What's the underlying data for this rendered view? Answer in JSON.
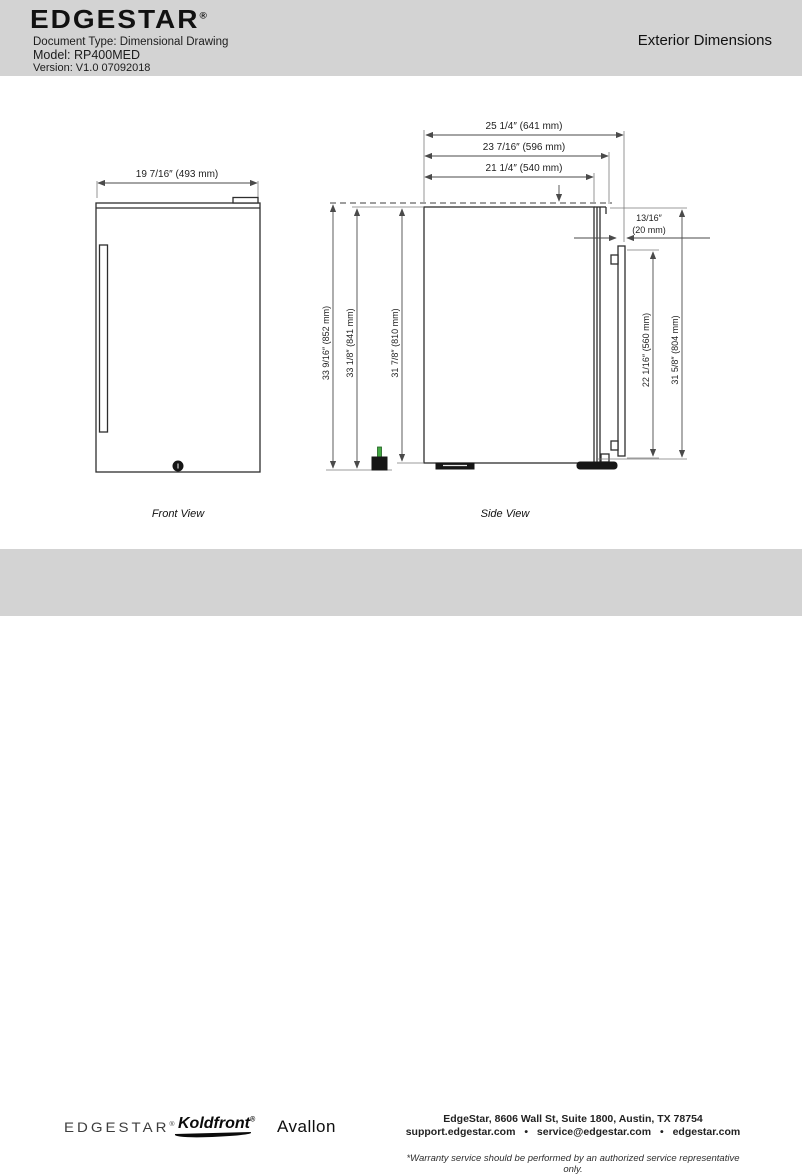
{
  "header": {
    "brand": "EDGESTAR",
    "registered": "®",
    "doc_type": "Document Type: Dimensional Drawing",
    "model": "Model: RP400MED",
    "version": "Version: V1.0 07092018",
    "page_title": "Exterior Dimensions"
  },
  "drawing": {
    "front_view": {
      "caption": "Front View",
      "width": "19 7/16″ (493 mm)"
    },
    "side_view": {
      "caption": "Side View",
      "depth_with_handle": "25 1/4″ (641 mm)",
      "depth_with_door": "23 7/16″ (596 mm)",
      "depth_cabinet": "21 1/4″ (540 mm)",
      "handle_clearance_in": "13/16″",
      "handle_clearance_mm": "(20 mm)",
      "top_clearance": "7/16″ (11 mm)",
      "height_total": "33 9/16″ (852 mm)",
      "height_with_hinge": "33 1/8″ (841 mm)",
      "height_cabinet": "31 7/8″ (810 mm)",
      "handle_length": "22 1/16″ (560 mm)",
      "door_height": "31 5/8″ (804 mm)"
    }
  },
  "footer": {
    "brand_edgestar": "EDGESTAR",
    "brand_koldfront": "Koldfront",
    "brand_avallon": "Avallon",
    "registered": "®",
    "address": "EdgeStar, 8606 Wall St, Suite 1800, Austin, TX 78754",
    "contacts": "support.edgestar.com • service@edgestar.com • edgestar.com",
    "warranty_note": "*Warranty service should be performed by an authorized service representative only."
  },
  "colors": {
    "band_gray": "#d3d3d3",
    "line_dark": "#2e2e2e",
    "dim_gray": "#4a4a4a",
    "plug_green": "#43a843"
  }
}
